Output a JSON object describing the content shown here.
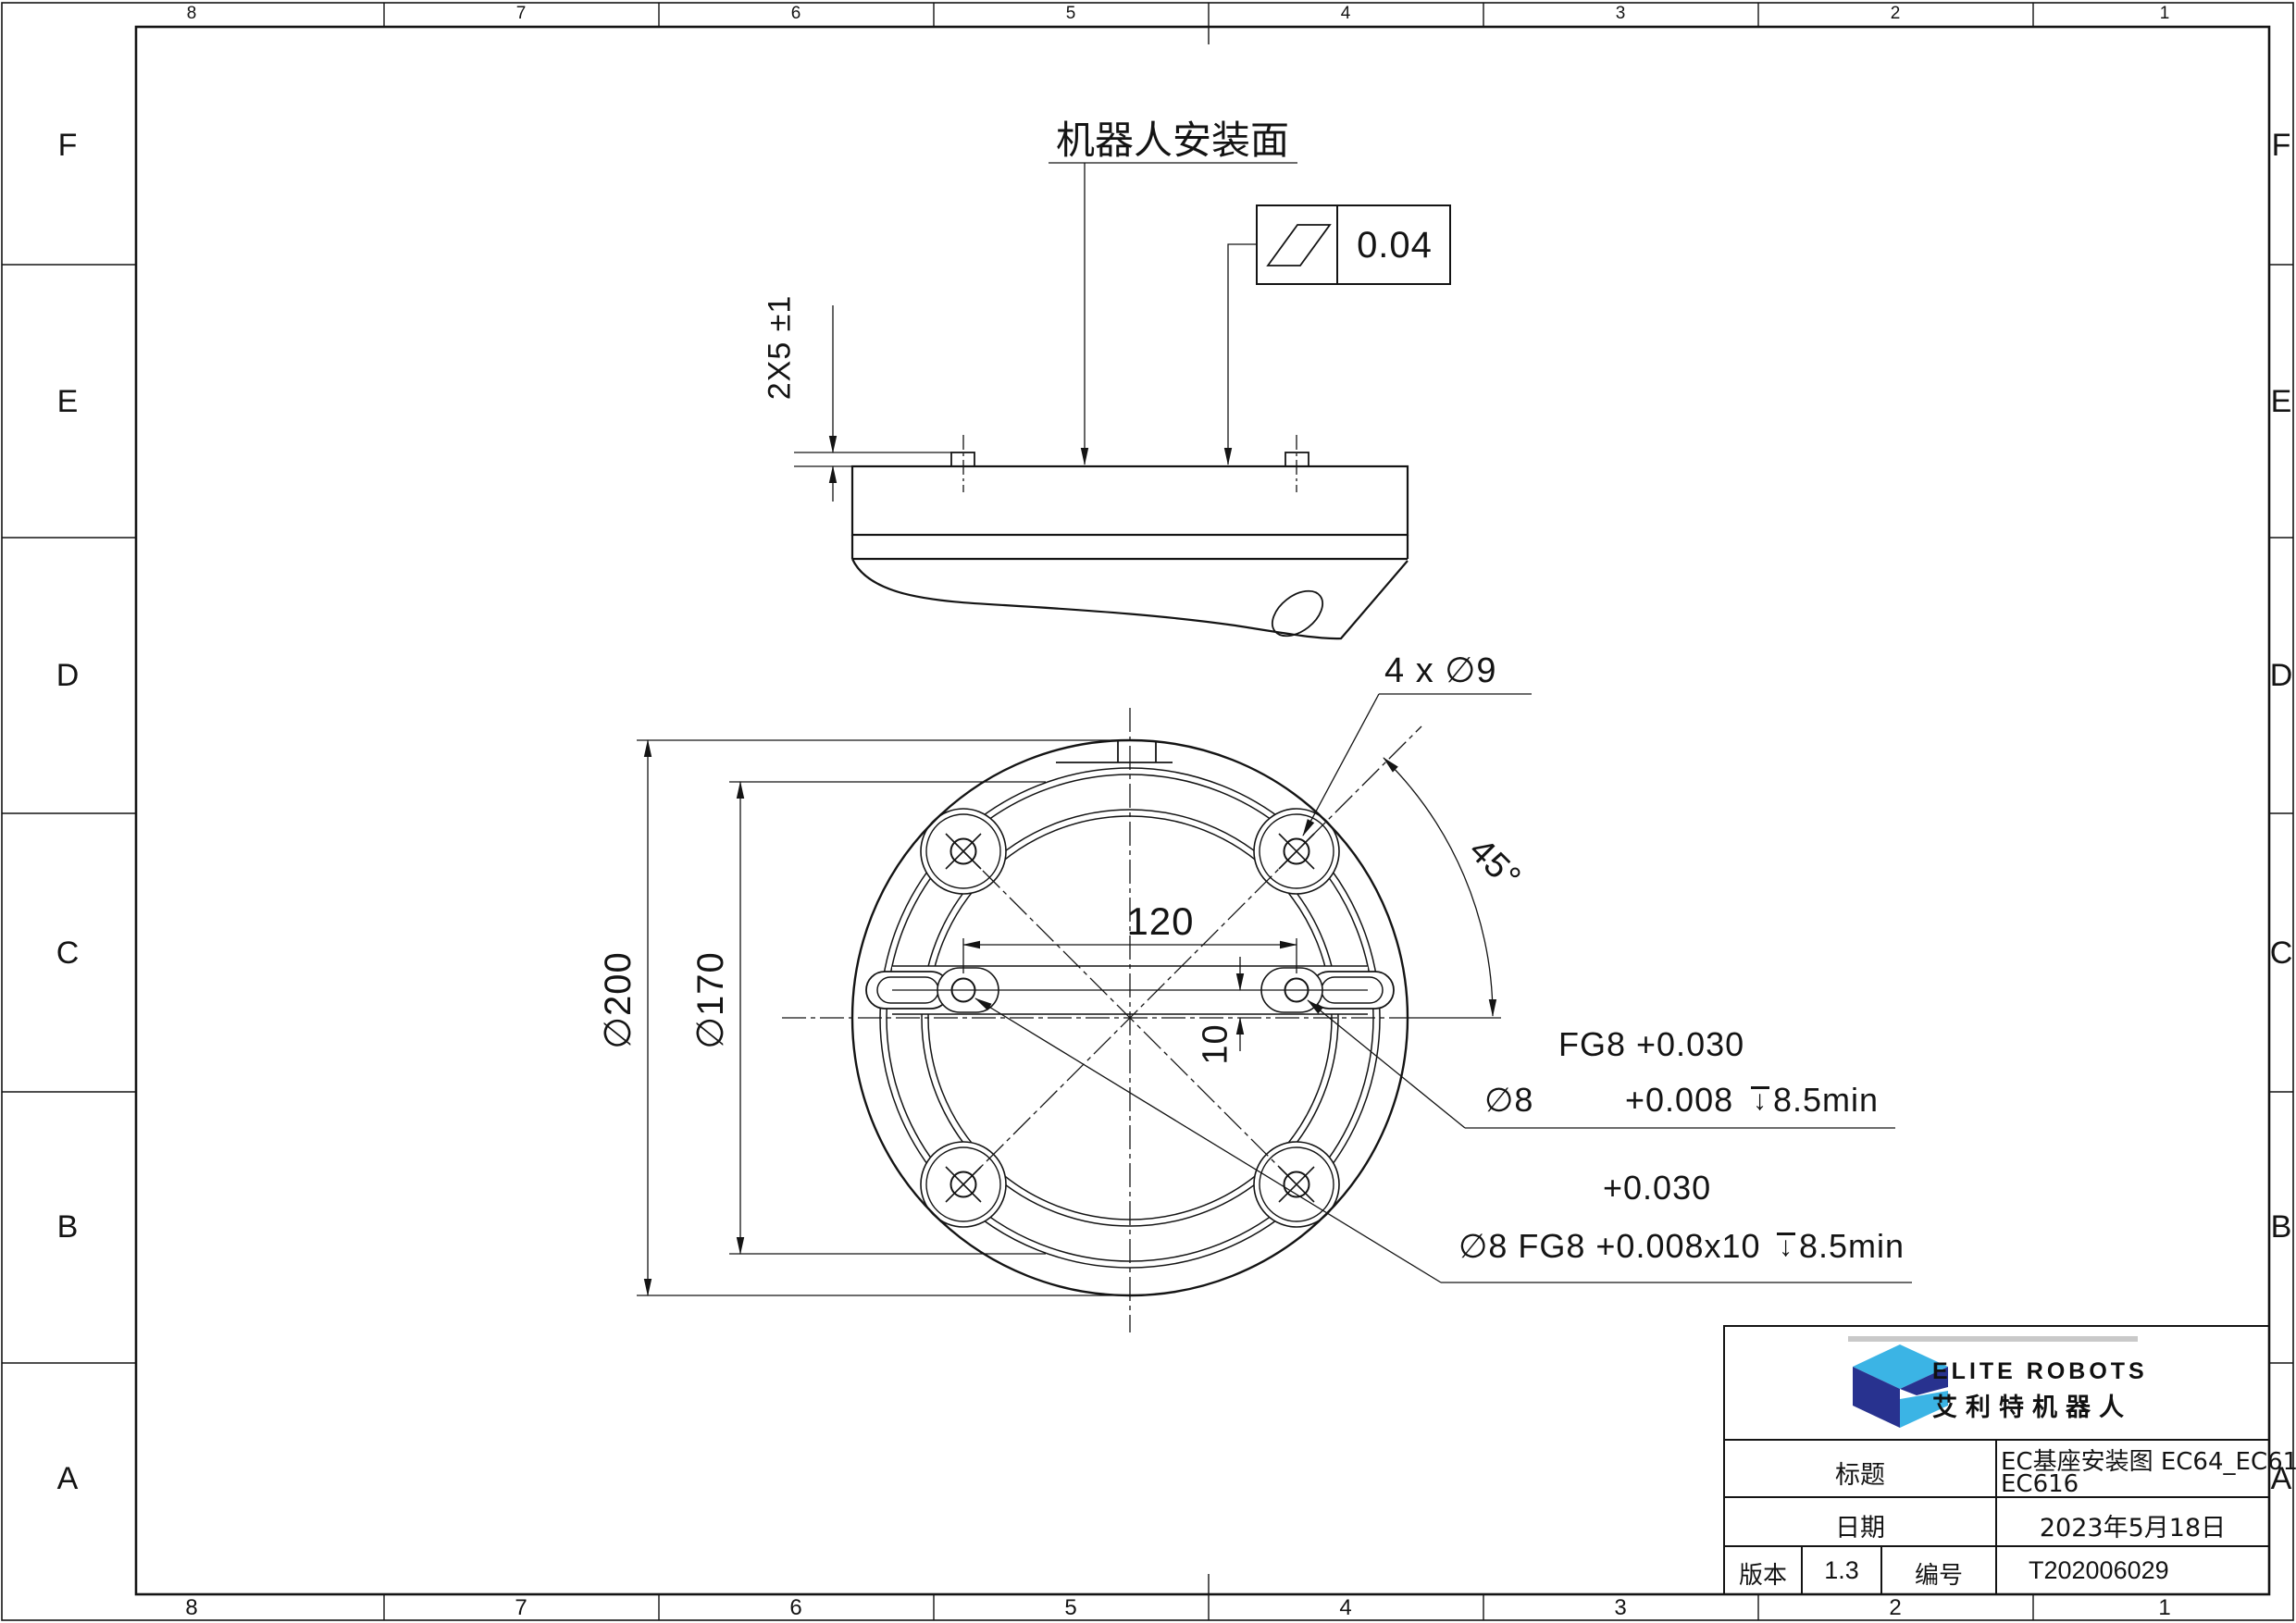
{
  "colors": {
    "line": "#141414",
    "brand_light_blue": "#3bb4e5",
    "brand_dark_blue": "#28328f",
    "logo_gray_bar": "#c9c9c9"
  },
  "zones": {
    "cols": [
      "8",
      "7",
      "6",
      "5",
      "4",
      "3",
      "2",
      "1"
    ],
    "rows": [
      "F",
      "E",
      "D",
      "C",
      "B",
      "A"
    ]
  },
  "side_view": {
    "pin_height_dim": "2X5 ±1",
    "mounting_surface_label": "机器人安装面",
    "flatness_tolerance": "0.04"
  },
  "plan_view": {
    "outer_diameter": "∅200",
    "bolt_circle_diameter": "∅170",
    "pin_spacing": "120",
    "pin_offset": "10",
    "bolt_holes_label": "4 x ∅9",
    "angle": "45°"
  },
  "callout_right_pin": {
    "line1": "FG8 +0.030",
    "dia": "∅8",
    "tol_lower": "+0.008",
    "depth": "8.5min"
  },
  "callout_left_pin": {
    "tol_upper": "+0.030",
    "line2": "∅8 FG8 +0.008x10",
    "depth": "8.5min"
  },
  "title_block": {
    "brand_en": "ELITE ROBOTS",
    "brand_cn": "艾利特机器人",
    "title_label": "标题",
    "title_value_line1": "EC基座安装图 EC64_EC612_",
    "title_value_line2": "EC616",
    "date_label": "日期",
    "date_value": "2023年5月18日",
    "version_label": "版本",
    "version_value": "1.3",
    "number_label": "编号",
    "number_value": "T202006029"
  }
}
